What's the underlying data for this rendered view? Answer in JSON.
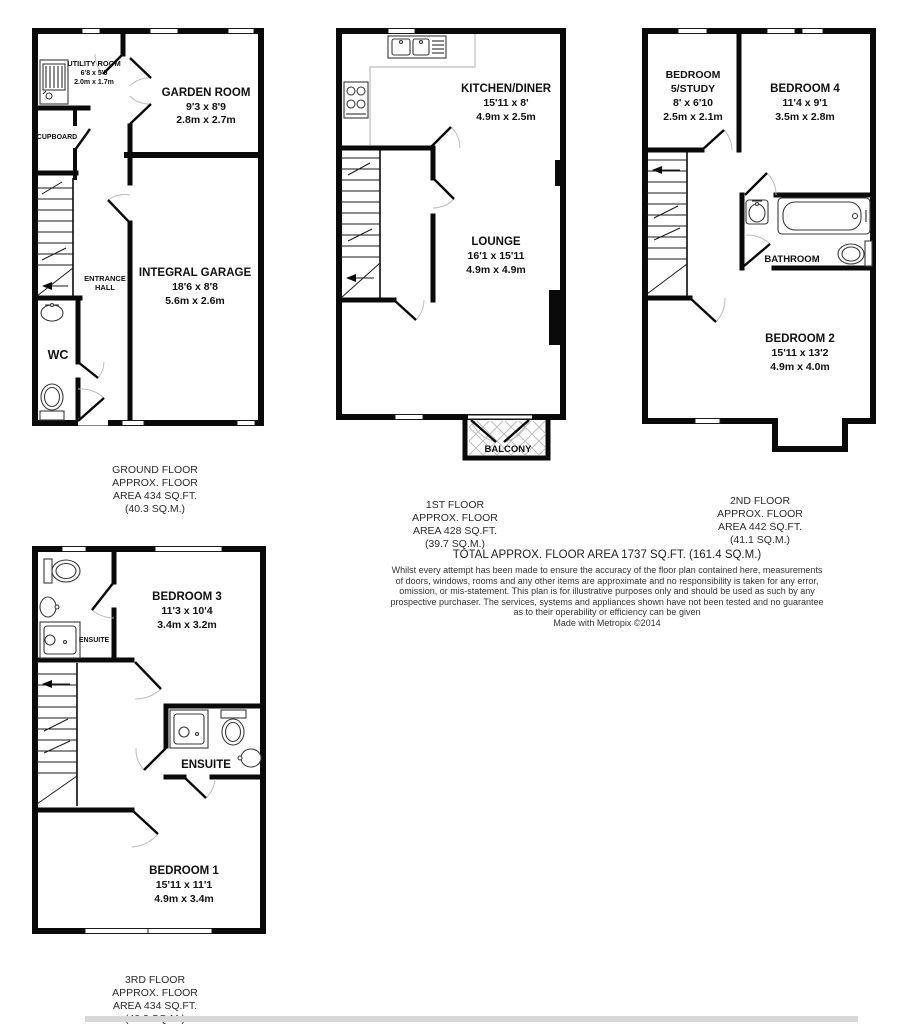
{
  "colors": {
    "wall": "#0a0a0a",
    "door_arc": "#bcbcbc",
    "counter": "#c8c8c8",
    "hatch": "#bdbdbd",
    "bottom_bar": "#d8d8d8"
  },
  "floors": {
    "ground": {
      "caption": {
        "line1": "GROUND FLOOR",
        "line2": "APPROX. FLOOR",
        "line3": "AREA 434 SQ.FT.",
        "line4": "(40.3 SQ.M.)"
      },
      "rooms": {
        "utility": {
          "name": "UTILITY ROOM",
          "imperial": "6'8 x 5'5",
          "metric": "2.0m x 1.7m"
        },
        "garden_room": {
          "name": "GARDEN ROOM",
          "imperial": "9'3 x 8'9",
          "metric": "2.8m x 2.7m"
        },
        "cupboard": {
          "name": "CUPBOARD"
        },
        "entrance_hall": {
          "line1": "ENTRANCE",
          "line2": "HALL"
        },
        "wc": {
          "name": "WC"
        },
        "garage": {
          "name": "INTEGRAL GARAGE",
          "imperial": "18'6 x 8'8",
          "metric": "5.6m x 2.6m"
        }
      }
    },
    "first": {
      "caption": {
        "line1": "1ST FLOOR",
        "line2": "APPROX. FLOOR",
        "line3": "AREA 428 SQ.FT.",
        "line4": "(39.7 SQ.M.)"
      },
      "rooms": {
        "kitchen_diner": {
          "name": "KITCHEN/DINER",
          "imperial": "15'11 x 8'",
          "metric": "4.9m x 2.5m"
        },
        "lounge": {
          "name": "LOUNGE",
          "imperial": "16'1 x 15'11",
          "metric": "4.9m x 4.9m"
        },
        "balcony": {
          "name": "BALCONY"
        }
      }
    },
    "second": {
      "caption": {
        "line1": "2ND FLOOR",
        "line2": "APPROX. FLOOR",
        "line3": "AREA 442 SQ.FT.",
        "line4": "(41.1 SQ.M.)"
      },
      "rooms": {
        "bedroom5": {
          "name_line1": "BEDROOM",
          "name_line2": "5/STUDY",
          "imperial": "8' x 6'10",
          "metric": "2.5m x 2.1m"
        },
        "bedroom4": {
          "name": "BEDROOM 4",
          "imperial": "11'4 x 9'1",
          "metric": "3.5m x 2.8m"
        },
        "bathroom": {
          "name": "BATHROOM"
        },
        "bedroom2": {
          "name": "BEDROOM 2",
          "imperial": "15'11 x 13'2",
          "metric": "4.9m x 4.0m"
        }
      }
    },
    "third": {
      "caption": {
        "line1": "3RD FLOOR",
        "line2": "APPROX. FLOOR",
        "line3": "AREA 434 SQ.FT.",
        "line4": "(40.3 SQ.M.)"
      },
      "rooms": {
        "ensuite_top": {
          "name": "ENSUITE"
        },
        "bedroom3": {
          "name": "BEDROOM 3",
          "imperial": "11'3 x 10'4",
          "metric": "3.4m x 3.2m"
        },
        "ensuite_mid": {
          "name": "ENSUITE"
        },
        "bedroom1": {
          "name": "BEDROOM 1",
          "imperial": "15'11 x 11'1",
          "metric": "4.9m x 3.4m"
        }
      }
    }
  },
  "summary": {
    "total_area": "TOTAL APPROX. FLOOR AREA 1737 SQ.FT. (161.4 SQ.M.)",
    "disclaimer": {
      "line1": "Whilst every attempt has been made to ensure the accuracy of the floor plan contained here, measurements",
      "line2": "of doors, windows, rooms and any other items are approximate and no responsibility is taken for any error,",
      "line3": "omission, or mis-statement. This plan is for illustrative purposes only and should be used as such by any",
      "line4": "prospective purchaser. The services, systems and appliances shown have not been tested and no guarantee",
      "line5": "as to their operability or efficiency can be given",
      "credit": "Made with Metropix ©2014"
    }
  }
}
